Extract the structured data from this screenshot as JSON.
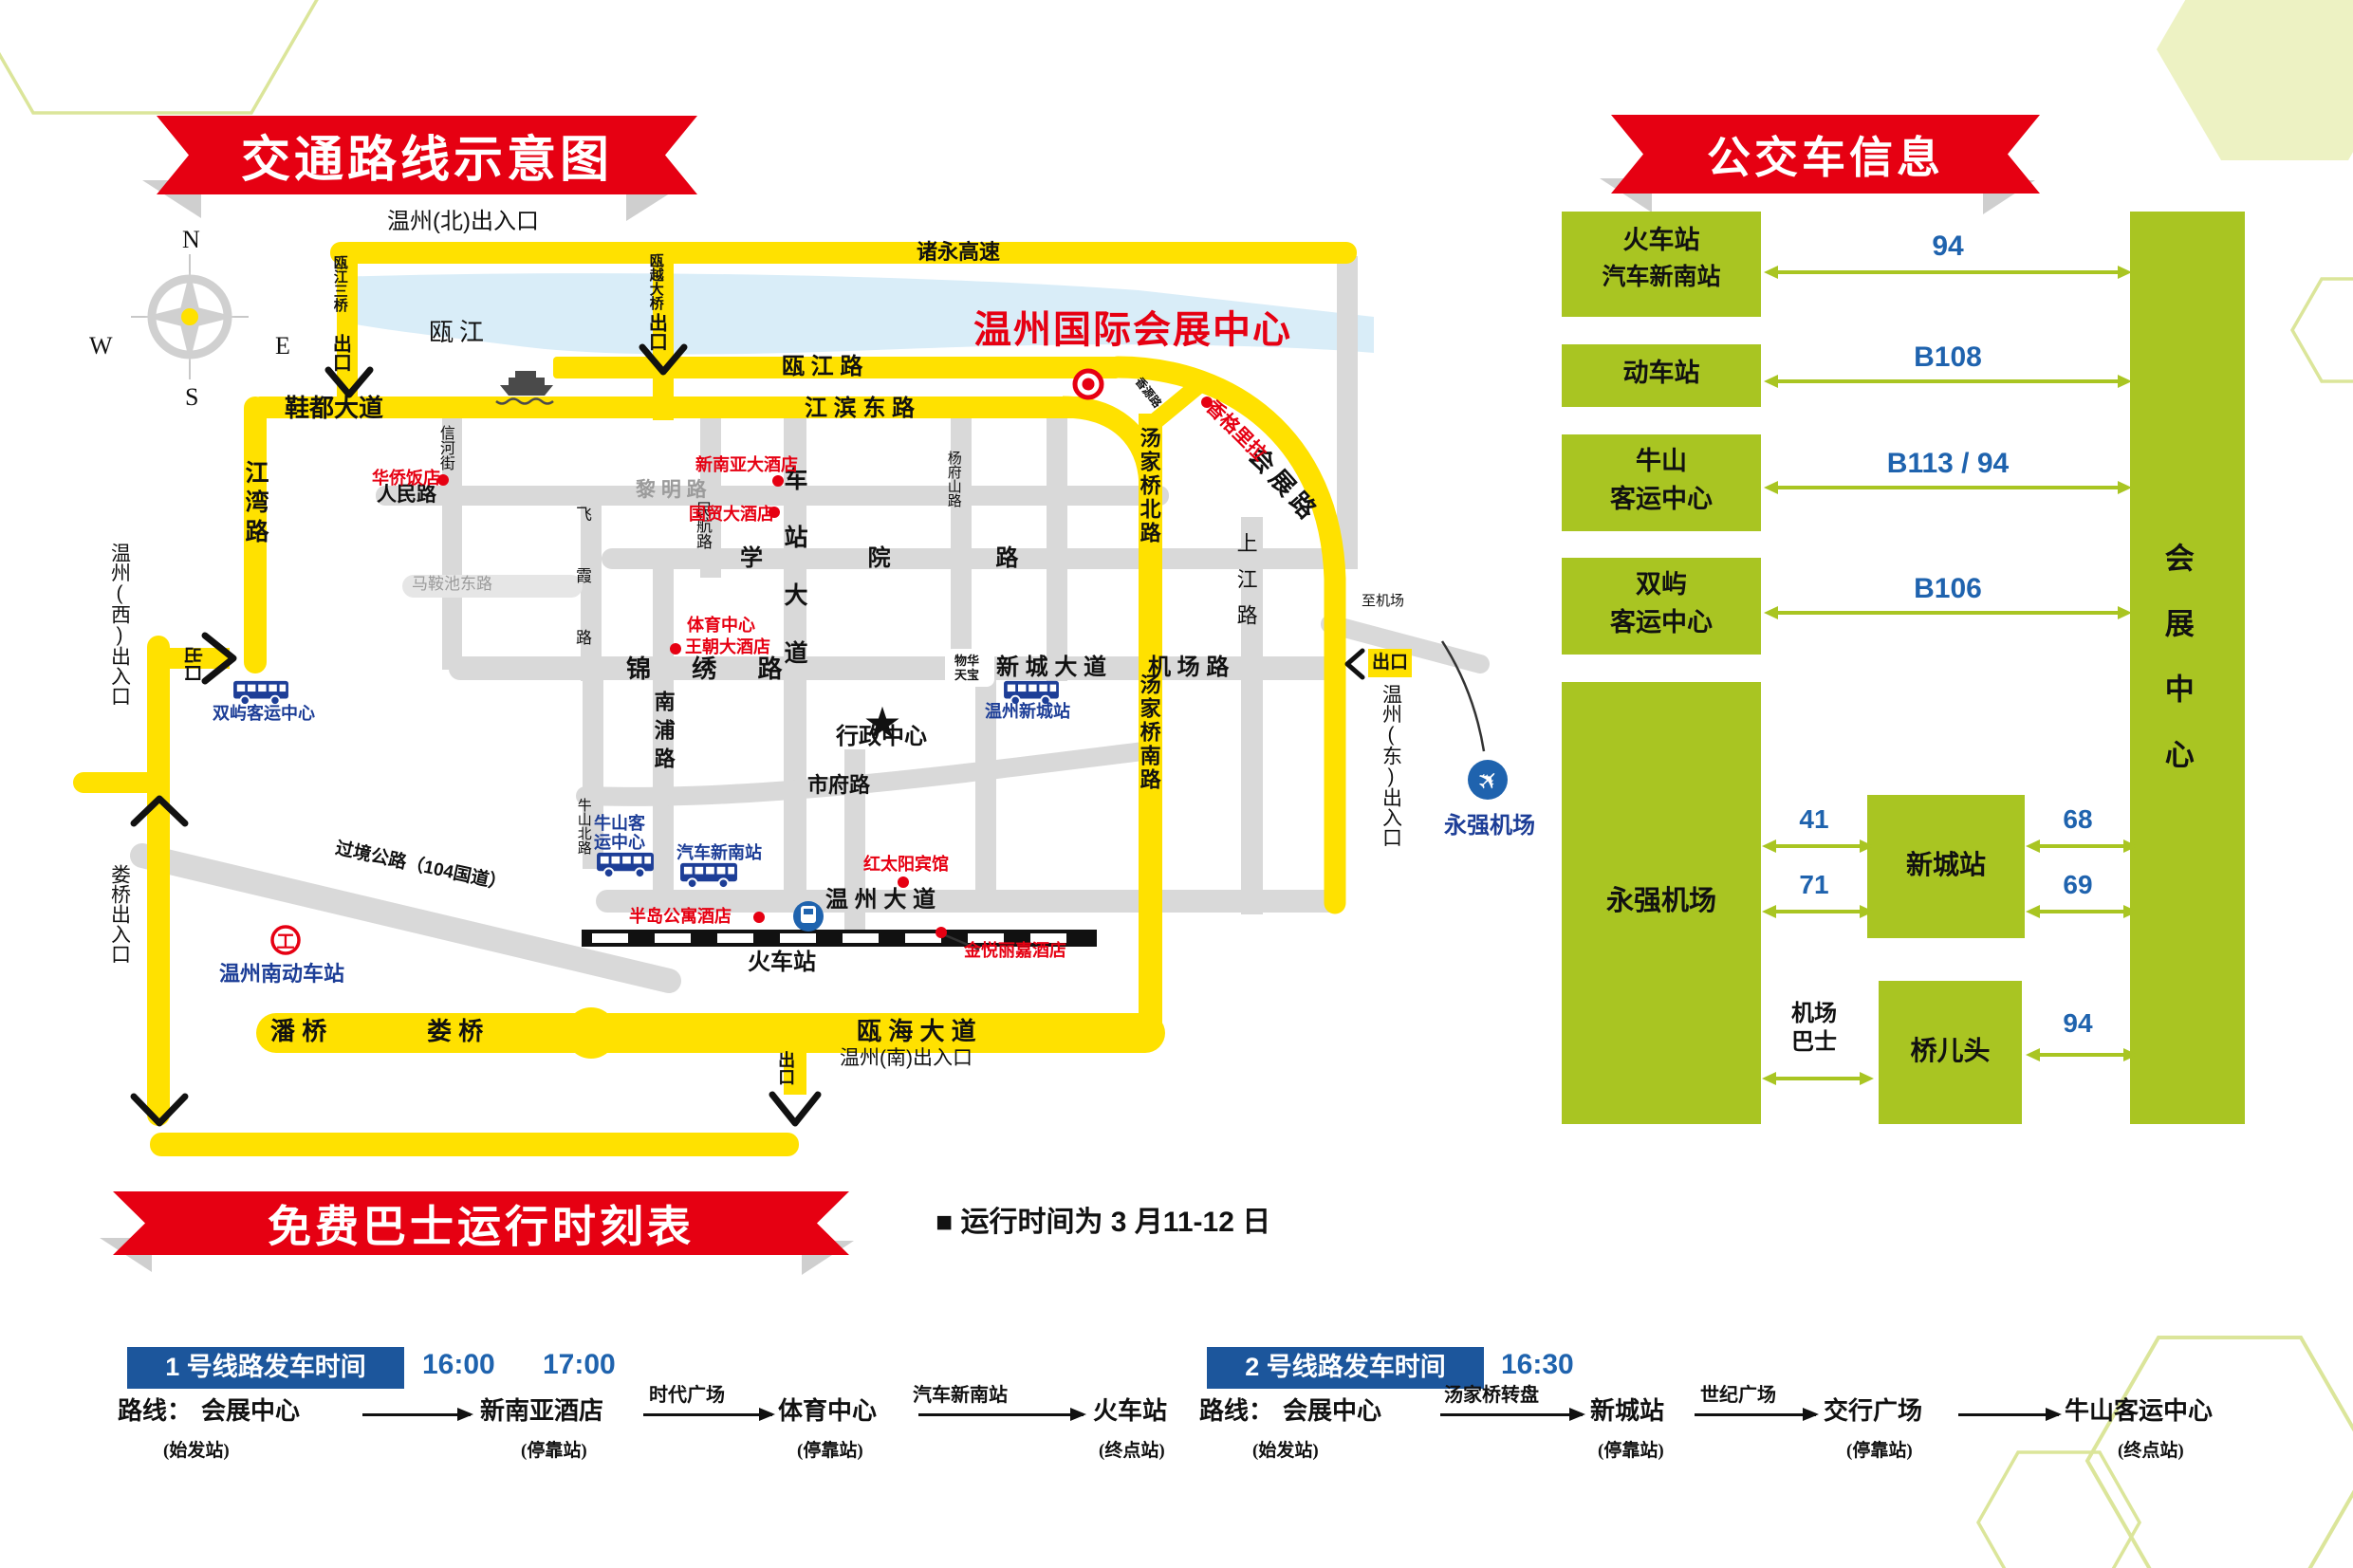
{
  "poster": {
    "map_banner": "交通路线示意图",
    "bus_banner": "公交车信息",
    "shuttle_banner": "免费巴士运行时刻表",
    "note": "■ 运行时间为 3 月11-12 日"
  },
  "compass": {
    "n": "N",
    "e": "E",
    "s": "S",
    "w": "W"
  },
  "map": {
    "entrances": {
      "north": "温州(北)出入口",
      "west": "温州(西)出入口",
      "east": "温州(东)出入口",
      "south": "温州(南)出入口",
      "louqiao": "娄桥出入口"
    },
    "exit": "出口",
    "to_airport": "至机场",
    "river": "瓯江",
    "roads": {
      "zhuyong": "诸永高速",
      "oujiang3": "瓯江三桥",
      "ouyue": "瓯越大桥",
      "oujiang_rd": "瓯 江 路",
      "jiangbin": "江 滨 东 路",
      "xiedu": "鞋都大道",
      "jiangwan": "江湾路",
      "xinhe": "信河街",
      "renmin": "人民路",
      "liming": "黎 明 路",
      "madong": "马鞍池东路",
      "feixia": "飞霞路",
      "minhang": "民航路",
      "chezhan": "车站大道",
      "xueyuan": "学 院 路",
      "jinxiu": "锦 绣 路",
      "nanpu": "南浦路",
      "niushan_n": "牛山北路",
      "guojing": "过境公路（104国道）",
      "shifu": "市府路",
      "wz_dadao": "温 州 大 道",
      "ouhai": "瓯 海 大 道",
      "panqiao": "潘 桥",
      "louqiao": "娄 桥",
      "yangfushan": "杨府山路",
      "wuhua1": "物华",
      "wuhua2": "天宝",
      "xincheng": "新 城 大 道",
      "jichang": "机 场 路",
      "shangjiang": "上江路",
      "tangjia_n": "汤家桥北路",
      "tangjia_s": "汤家桥南路",
      "huiyuan": "香源路",
      "huizhan": "会展路"
    },
    "pois": {
      "center": "温州国际会展中心",
      "huaqiao": "华侨饭店",
      "xinnanya": "新南亚大酒店",
      "guomao": "国贸大酒店",
      "tiyu": "体育中心",
      "wangchao": "王朝大酒店",
      "xianggelila": "香格里拉",
      "hongtaiyang": "红太阳宾馆",
      "bandao": "半岛公寓酒店",
      "jinyue": "金悦丽嘉酒店",
      "xingzheng": "行政中心",
      "huochezhan": "火车站",
      "shuangyu": "双屿客运中心",
      "niushan1": "牛山客",
      "niushan2": "运中心",
      "qiche": "汽车新南站",
      "wzxincheng": "温州新城站",
      "wznan": "温州南动车站",
      "yongqiang": "永强机场"
    }
  },
  "bus_panel": {
    "stops": {
      "s1a": "火车站",
      "s1b": "汽车新南站",
      "s2": "动车站",
      "s3a": "牛山",
      "s3b": "客运中心",
      "s4a": "双屿",
      "s4b": "客运中心",
      "s5": "永强机场",
      "xincheng": "新城站",
      "qiaoertou": "桥儿头",
      "center": "会展中心",
      "jb1": "机场",
      "jb2": "巴士"
    },
    "routes": {
      "r1": "94",
      "r2": "B108",
      "r3": "B113 / 94",
      "r4": "B106",
      "r41": "41",
      "r71": "71",
      "r68": "68",
      "r69": "69",
      "r94b": "94"
    }
  },
  "shuttle": {
    "line1": {
      "header": "1 号线路发车时间",
      "t1": "16:00",
      "t2": "17:00",
      "prefix": "路线：",
      "s1": "会展中心",
      "s2": "新南亚酒店",
      "s3": "体育中心",
      "s4": "火车站",
      "v2": "时代广场",
      "v3": "汽车新南站",
      "g1": "(始发站)",
      "g2": "(停靠站)",
      "g3": "(停靠站)",
      "g4": "(终点站)"
    },
    "line2": {
      "header": "2 号线路发车时间",
      "t1": "16:30",
      "prefix": "路线：",
      "s1": "会展中心",
      "s2": "新城站",
      "s3": "交行广场",
      "s4": "牛山客运中心",
      "v1": "汤家桥转盘",
      "v2": "世纪广场",
      "g1": "(始发站)",
      "g2": "(停靠站)",
      "g3": "(停靠站)",
      "g4": "(终点站)"
    }
  },
  "colors": {
    "red": "#e60012",
    "yellow": "#ffe100",
    "green": "#a9c522",
    "blue_num": "#1f63ae",
    "blue_poi": "#1d3e97",
    "navy_box": "#1c569c",
    "gray_road": "#d9d9d9",
    "river": "#d9edf8"
  }
}
